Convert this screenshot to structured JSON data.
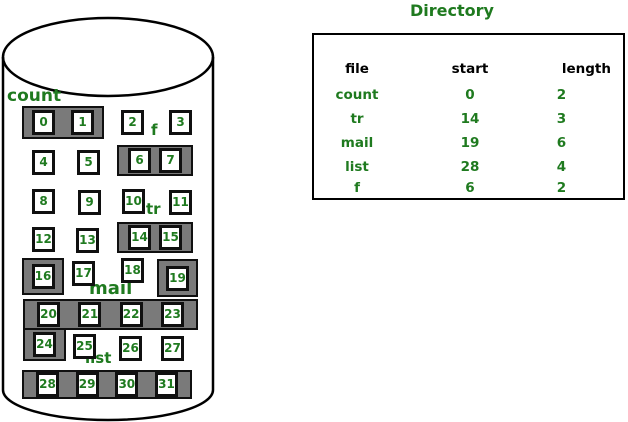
{
  "colors": {
    "green": "#1f7a1f",
    "gray": "#7a7a7a"
  },
  "directory": {
    "title": "Directory",
    "headers": {
      "file": "file",
      "start": "start",
      "length": "length"
    },
    "rows": [
      {
        "file": "count",
        "start": "0",
        "length": "2"
      },
      {
        "file": "tr",
        "start": "14",
        "length": "3"
      },
      {
        "file": "mail",
        "start": "19",
        "length": "6"
      },
      {
        "file": "list",
        "start": "28",
        "length": "4"
      },
      {
        "file": "f",
        "start": "6",
        "length": "2"
      }
    ]
  },
  "disk": {
    "labels": {
      "count": "count",
      "f": "f",
      "tr": "tr",
      "mail": "mail",
      "list": "list"
    },
    "blocks": [
      "0",
      "1",
      "2",
      "3",
      "4",
      "5",
      "6",
      "7",
      "8",
      "9",
      "10",
      "11",
      "12",
      "13",
      "14",
      "15",
      "16",
      "17",
      "18",
      "19",
      "20",
      "21",
      "22",
      "23",
      "24",
      "25",
      "26",
      "27",
      "28",
      "29",
      "30",
      "31"
    ],
    "allocations": [
      {
        "file": "count",
        "blocks": [
          0,
          1
        ]
      },
      {
        "file": "f",
        "blocks": [
          6,
          7
        ]
      },
      {
        "file": "tr",
        "blocks": [
          14,
          15,
          16
        ]
      },
      {
        "file": "mail",
        "blocks": [
          19,
          20,
          21,
          22,
          23,
          24
        ]
      },
      {
        "file": "list",
        "blocks": [
          28,
          29,
          30,
          31
        ]
      }
    ]
  }
}
